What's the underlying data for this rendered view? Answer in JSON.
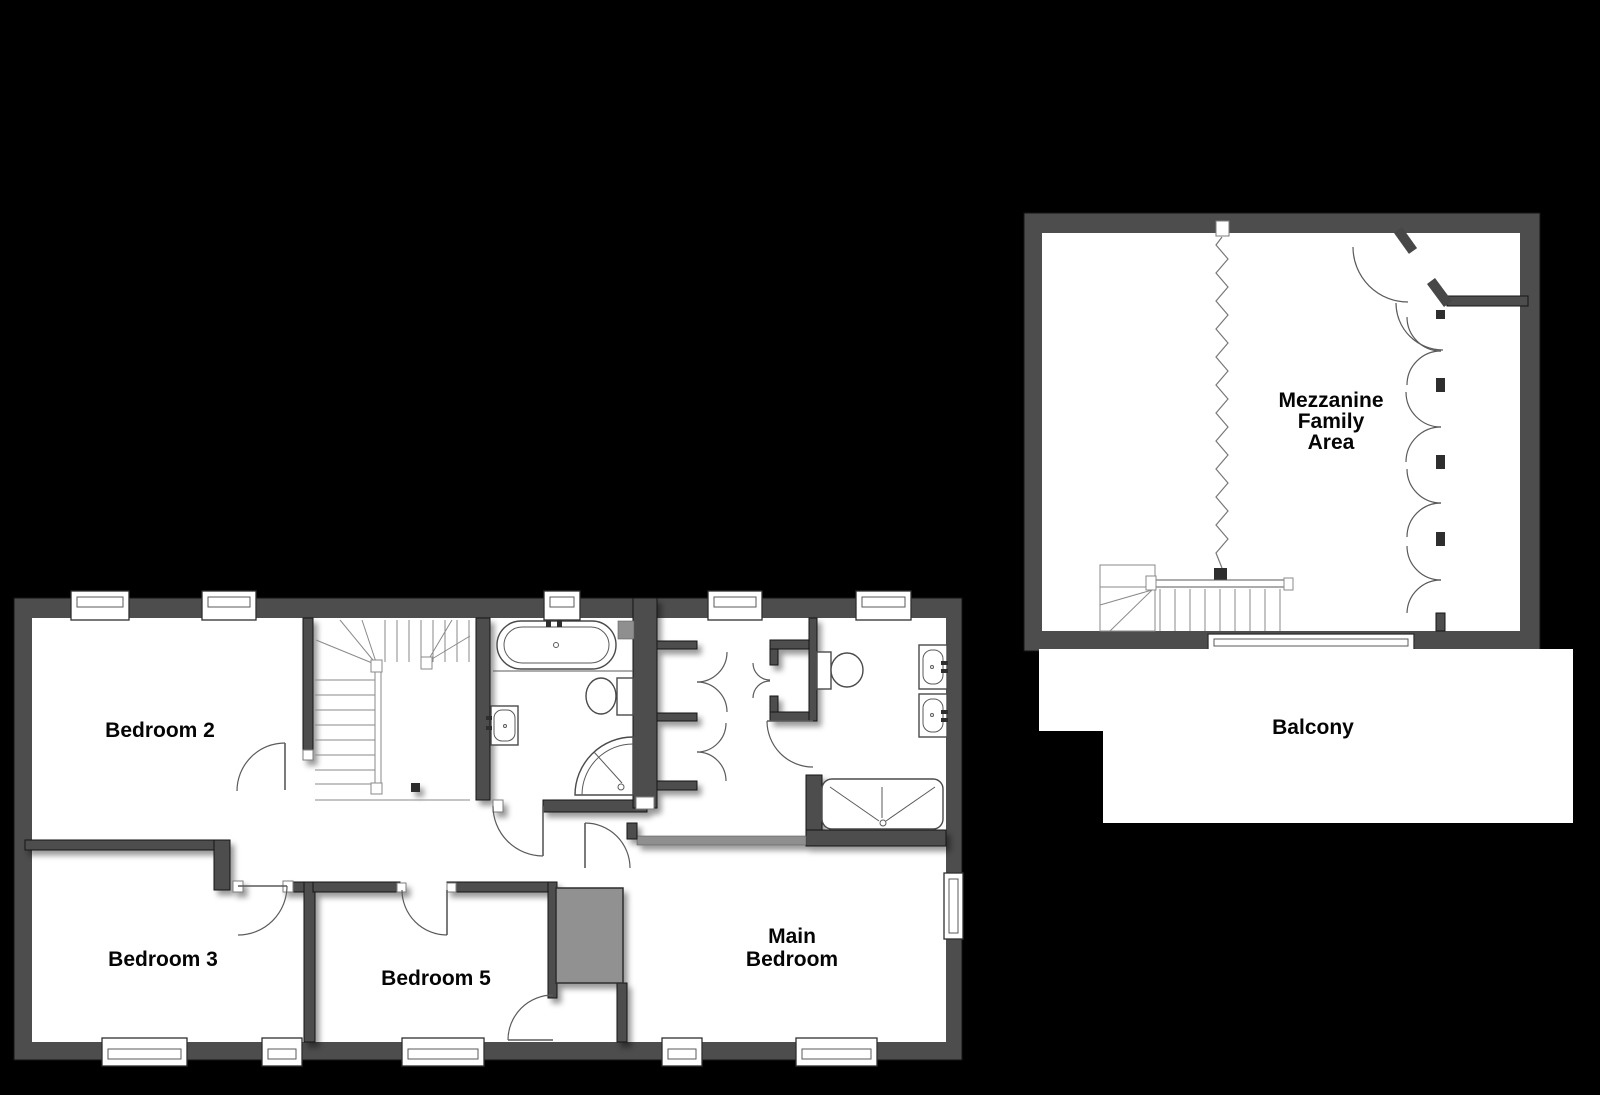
{
  "plan": {
    "type": "floorplan",
    "areas": {
      "bedroom2": {
        "label": "Bedroom 2"
      },
      "bedroom3": {
        "label": "Bedroom 3"
      },
      "bedroom5": {
        "label": "Bedroom 5"
      },
      "main_bedroom": {
        "line1": "Main",
        "line2": "Bedroom"
      },
      "mezzanine": {
        "line1": "Mezzanine",
        "line2": "Family",
        "line3": "Area"
      },
      "balcony": {
        "label": "Balcony"
      }
    }
  },
  "colors": {
    "background": "#000000",
    "wall": "#4d4d4d",
    "wall_light": "#8f8f8f",
    "floor": "#ffffff",
    "void_fill": "#919191",
    "fixture_line": "#5a5a5a",
    "label_text": "#000000"
  }
}
